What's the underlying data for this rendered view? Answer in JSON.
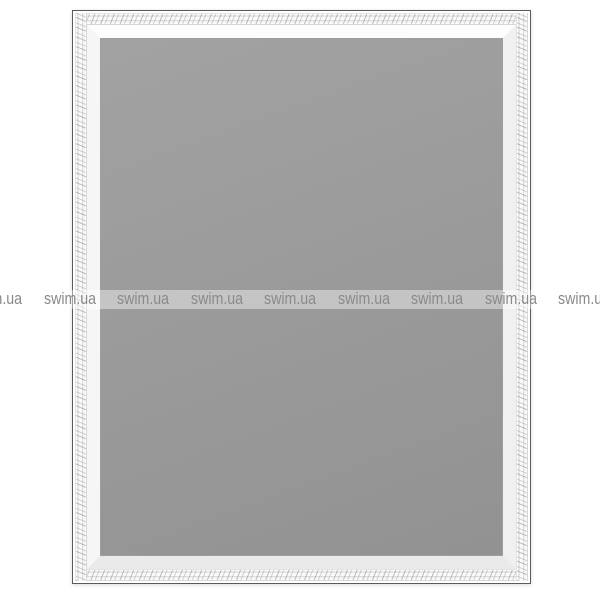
{
  "image": {
    "description": "Product photo of a rectangular mirror in a white ornate carved frame with repeating shop watermark"
  },
  "colors": {
    "bg": "#ffffff",
    "frameWhite": "#ffffff",
    "frameOutline": "#5a5a5a",
    "glassTop": "#a2a2a2",
    "glassBottom": "#929292",
    "wmBand": "rgba(255,255,255,0.42)",
    "wmText": "#8a8a8a"
  },
  "watermark": {
    "text": "swim.ua",
    "count": 9,
    "items": [
      "swim.ua",
      "swim.ua",
      "swim.ua",
      "swim.ua",
      "swim.ua",
      "swim.ua",
      "swim.ua",
      "swim.ua",
      "swim.ua"
    ]
  }
}
